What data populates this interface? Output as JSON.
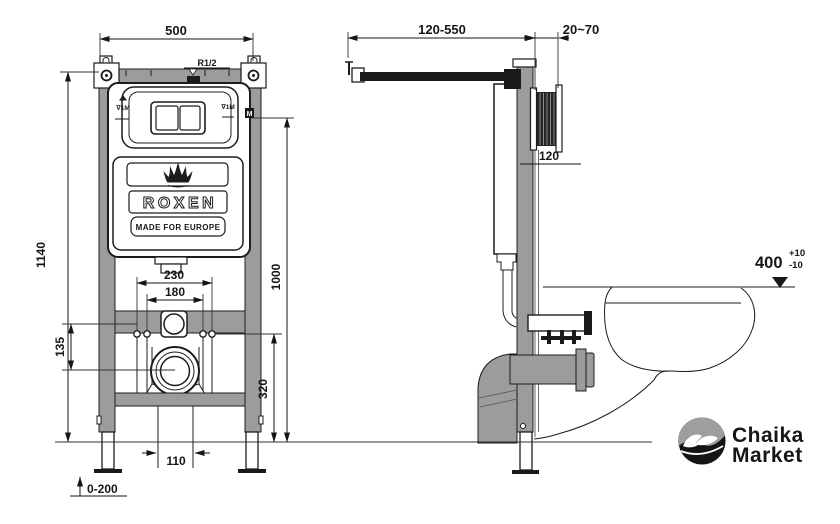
{
  "colors": {
    "steel": "#9c9c9c",
    "ink": "#1a1a1a",
    "white": "#ffffff"
  },
  "front_view": {
    "dim_width": "500",
    "dim_frame_height": "1140",
    "dim_flush_plate_height": "1000",
    "dim_fixing_outer": "230",
    "dim_fixing_inner": "180",
    "dim_crossbar_offset": "135",
    "dim_drain_height": "320",
    "dim_drain_pipe": "110",
    "dim_feet_adjust": "0-200",
    "water_connection": "R1/2",
    "level_mark_left": "∇1M",
    "level_mark_right": "∇1M",
    "meter_mark": "M",
    "logo_text": "ROXEN",
    "logo_tagline": "MADE FOR EUROPE"
  },
  "side_view": {
    "dim_supply_depth": "120-550",
    "dim_wall_thickness": "20~70",
    "dim_plate": "120",
    "dim_bowl_height": "400",
    "tolerance_plus": "+10",
    "tolerance_minus": "-10"
  },
  "branding": {
    "name_line1": "Chaika",
    "name_line2": "Market"
  }
}
